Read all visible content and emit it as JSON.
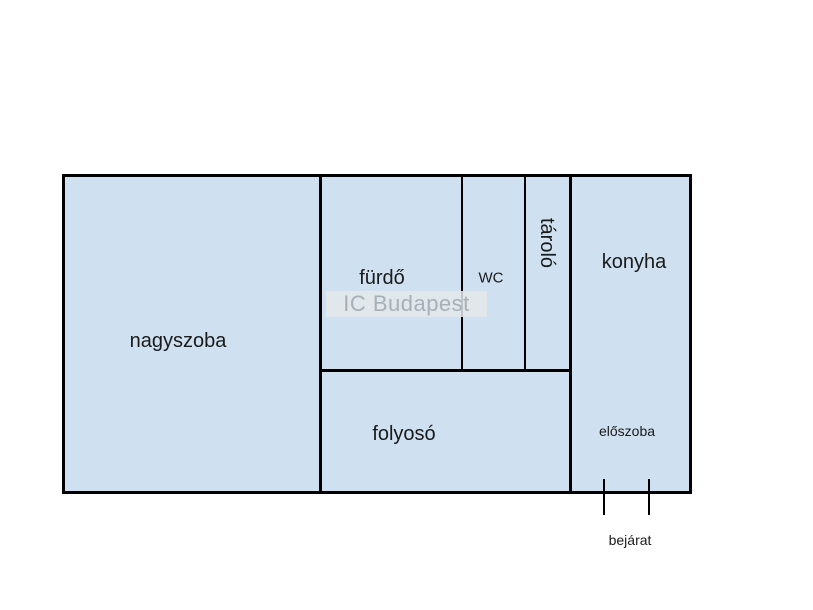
{
  "floorplan": {
    "watermark": {
      "text": "IC Budapest"
    },
    "rooms": {
      "nagyszoba": "nagyszoba",
      "furdo": "fürdő",
      "wc": "WC",
      "tarolo": "tároló",
      "konyha": "konyha",
      "folyoso": "folyosó",
      "eloszoba": "előszoba"
    },
    "entrance": {
      "label": "bejárat"
    },
    "colors": {
      "page_bg": "#ffffff",
      "room_fill": "#cfe1f1",
      "wall": "#000000",
      "label_text": "#1a1a1a",
      "watermark_text": "#a7b0b8",
      "watermark_bg": "rgba(228,231,234,0.85)"
    }
  }
}
